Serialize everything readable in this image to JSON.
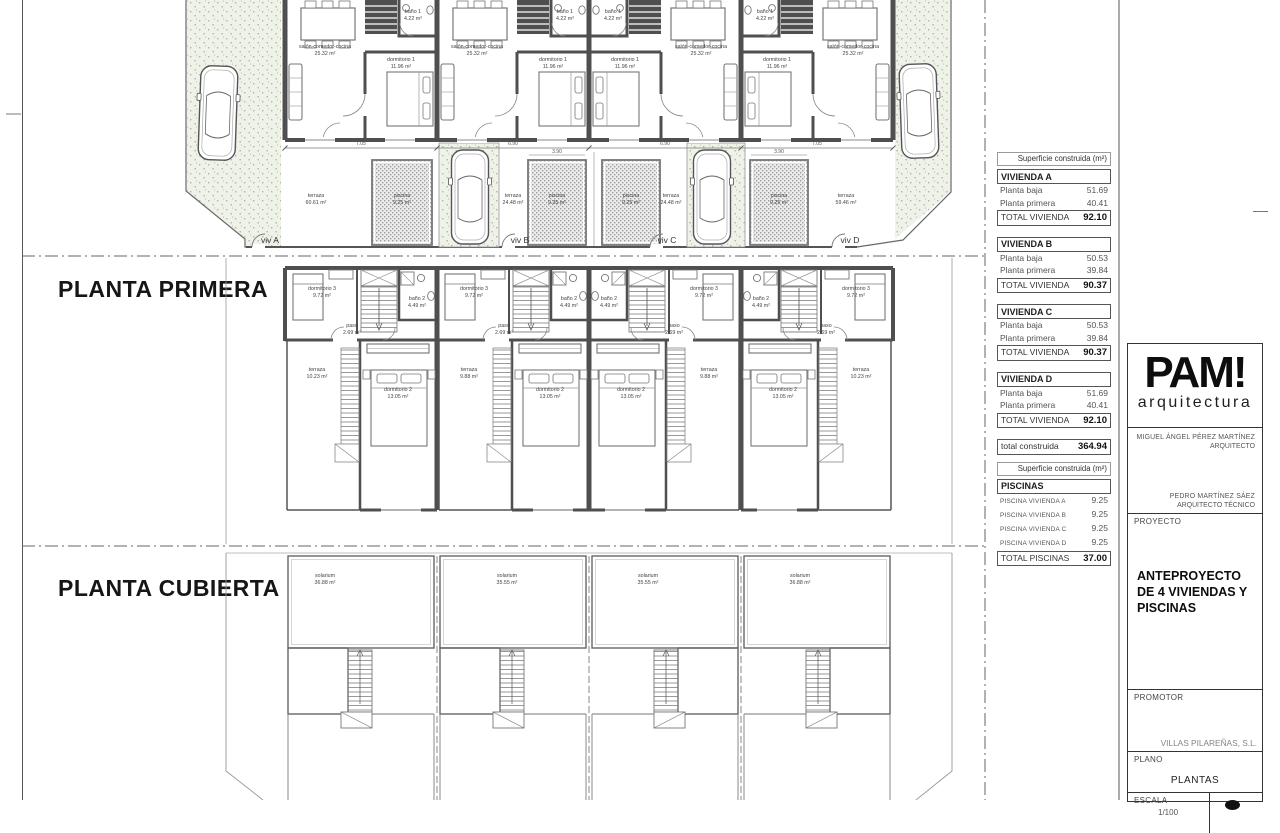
{
  "plan": {
    "headings": {
      "primera": "PLANTA PRIMERA",
      "cubierta": "PLANTA CUBIERTA"
    },
    "ground": {
      "salon": "salón-comedor-cocina",
      "salon_area": "25.32 m²",
      "dorm1": "dormitorio 1",
      "dorm1_area": "11.96 m²",
      "bano1": "baño 1",
      "bano1_area": "4.22 m²",
      "terraza": "terraza",
      "terraza_areas": [
        "60.61 m²",
        "24.48 m²",
        "24.48 m²",
        "59.46 m²"
      ],
      "piscina": "piscina",
      "piscina_area": "9.25 m²",
      "viv": [
        "viv A",
        "viv B",
        "viv C",
        "viv D"
      ],
      "dims": [
        "7.05",
        "6.90",
        "6.90",
        "7.05"
      ],
      "pool_dim": "3.90"
    },
    "primera": {
      "dorm3": "dormitorio 3",
      "dorm3_area": "9.72 m²",
      "bano2": "baño 2",
      "bano2_area": "4.49 m²",
      "paso": "paso",
      "paso_area": "2.69 m²",
      "dorm2": "dormitorio 2",
      "dorm2_area": "13.05 m²",
      "terraza": "terraza",
      "terraza_areas": [
        "10.23 m²",
        "9.88 m²",
        "9.88 m²",
        "10.23 m²"
      ]
    },
    "cubierta": {
      "solarium": "solarium",
      "areas": [
        "36.88 m²",
        "35.55 m²",
        "35.55 m²",
        "36.88 m²"
      ]
    }
  },
  "tables": {
    "header": "Superficie construida (m²)",
    "viviendas": [
      {
        "name": "VIVIENDA A",
        "r1l": "Planta baja",
        "r1v": "51.69",
        "r2l": "Planta primera",
        "r2v": "40.41",
        "tl": "TOTAL VIVIENDA",
        "tv": "92.10"
      },
      {
        "name": "VIVIENDA B",
        "r1l": "Planta baja",
        "r1v": "50.53",
        "r2l": "Planta primera",
        "r2v": "39.84",
        "tl": "TOTAL VIVIENDA",
        "tv": "90.37"
      },
      {
        "name": "VIVIENDA C",
        "r1l": "Planta baja",
        "r1v": "50.53",
        "r2l": "Planta primera",
        "r2v": "39.84",
        "tl": "TOTAL VIVIENDA",
        "tv": "90.37"
      },
      {
        "name": "VIVIENDA D",
        "r1l": "Planta baja",
        "r1v": "51.69",
        "r2l": "Planta primera",
        "r2v": "40.41",
        "tl": "TOTAL VIVIENDA",
        "tv": "92.10"
      }
    ],
    "total_label": "total construida",
    "total_value": "364.94",
    "piscinas": {
      "header": "Superficie construida (m²)",
      "title": "PISCINAS",
      "rows": [
        {
          "l": "PISCINA VIVIENDA A",
          "v": "9.25"
        },
        {
          "l": "PISCINA VIVIENDA B",
          "v": "9.25"
        },
        {
          "l": "PISCINA VIVIENDA C",
          "v": "9.25"
        },
        {
          "l": "PISCINA VIVIENDA D",
          "v": "9.25"
        }
      ],
      "total_label": "TOTAL PISCINAS",
      "total_value": "37.00"
    }
  },
  "titleblock": {
    "logo": "PAM!",
    "logo_sub": "arquitectura",
    "architect1": "MIGUEL ÁNGEL PÉREZ MARTÍNEZ",
    "role1": "ARQUITECTO",
    "architect2": "PEDRO MARTÍNEZ SÁEZ",
    "role2": "ARQUITECTO TÉCNICO",
    "proyecto_label": "PROYECTO",
    "proyecto": "ANTEPROYECTO DE 4 VIVIENDAS Y PISCINAS",
    "promotor_label": "PROMOTOR",
    "promotor": "VILLAS PILAREÑAS, S.L.",
    "plano_label": "PLANO",
    "plano": "PLANTAS",
    "escala_label": "ESCALA",
    "escala": "1/100"
  }
}
